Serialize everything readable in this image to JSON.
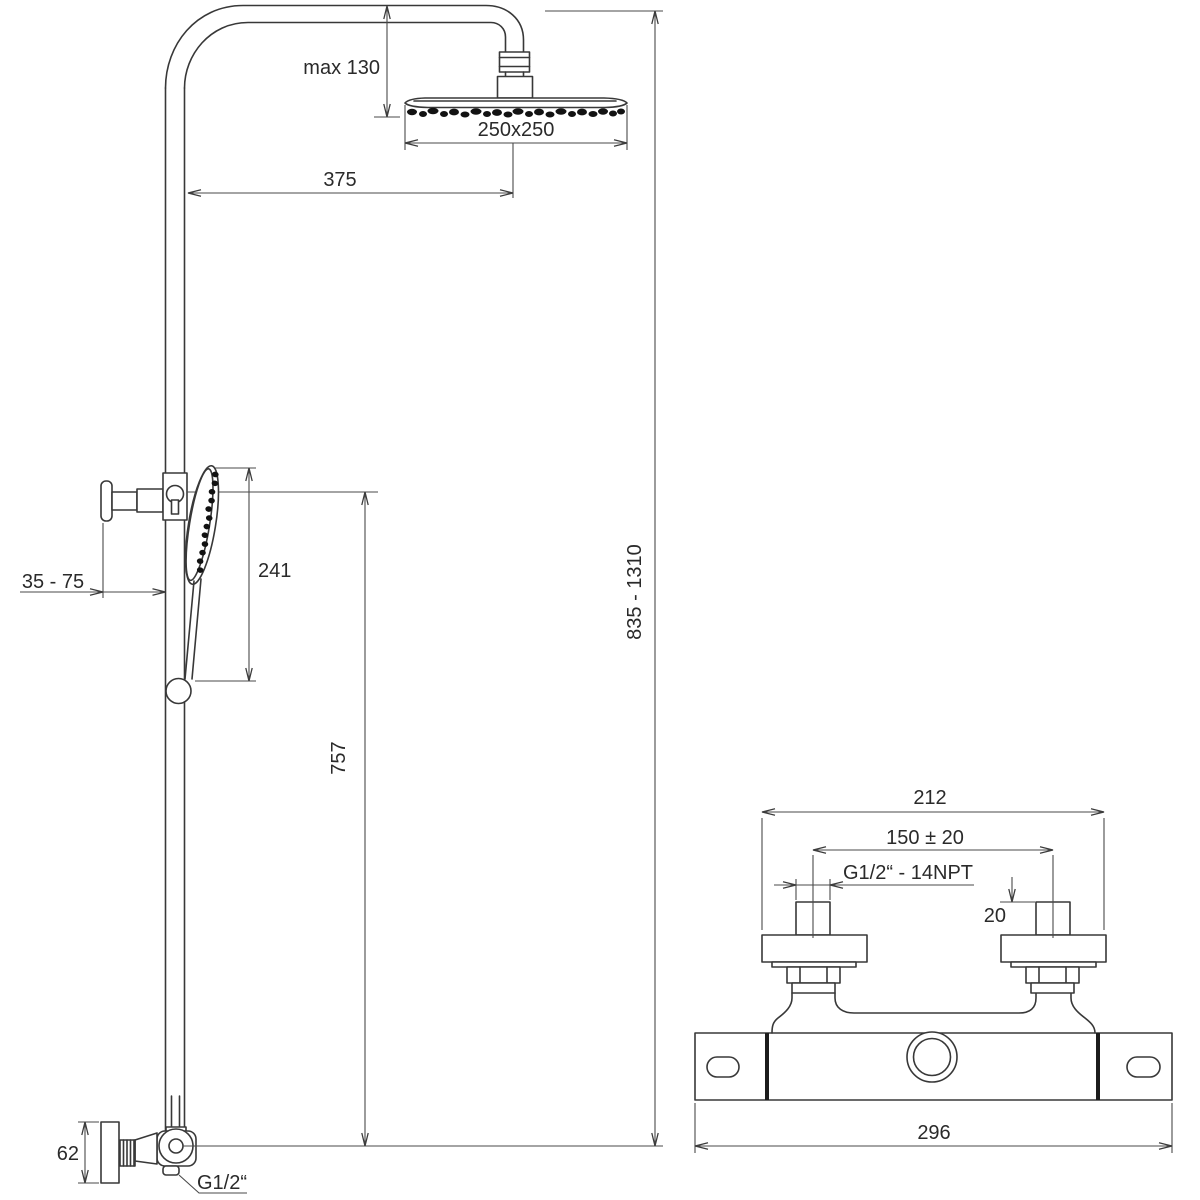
{
  "drawing": {
    "type": "technical-dimension-drawing",
    "subject": "shower column with thermostatic mixer",
    "colors": {
      "line": "#383838",
      "dimension": "#4a4a4a",
      "text": "#2a2a2a",
      "background": "#ffffff"
    },
    "shower_column": {
      "max_head_drop": "max 130",
      "head_size": "250x250",
      "arm_reach": "375",
      "hand_shower_length": "241",
      "wall_clearance": "35 - 75",
      "rail_travel": "757",
      "overall_height": "835 - 1310",
      "wall_plate_height": "62",
      "inlet_thread": "G1/2“"
    },
    "mixer_valve": {
      "body_width": "212",
      "inlet_centers": "150 ± 20",
      "thread_spec": "G1/2“ - 14NPT",
      "stub_height": "20",
      "overall_width": "296"
    }
  }
}
